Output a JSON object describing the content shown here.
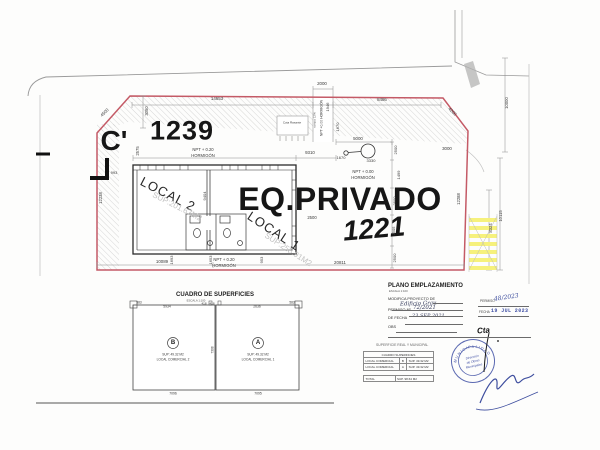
{
  "plan": {
    "parcel_top": "1239",
    "parcel_main": "1221",
    "area_label": "EQ.PRIVADO",
    "section_marker": "C'",
    "local2": "LOCAL 2",
    "local2_sup": "SUP:201.67M2",
    "local1": "LOCAL 1",
    "local1_sup": "SUP:258.91M2",
    "npt020": "NPT + 0.20",
    "npt000": "NPT + 0.00",
    "hormigon": "HORMIGÓN",
    "npt000_vertical": "NPT +0.00 HORMIGÓN",
    "rampa": "rampa 12%",
    "cota": "Cota Rasante",
    "dims": {
      "top_left": "14653",
      "entry_width": "2000",
      "top_right": "8486",
      "chamfer_left": "4500",
      "chamfer_right": "4200",
      "sidewalk_depth": "3050",
      "left_2575": "2575",
      "left_993": "993",
      "left_boundary": "12238",
      "building_front": "9310",
      "court_5000": "5000",
      "entry_1946": "1946",
      "entry_1670": "1670",
      "pole_offset": "1670",
      "pole_3330": "3330",
      "right_3000": "3000",
      "col_2500a": "2500",
      "col_1499": "1499",
      "col_2500b": "2500",
      "col_2505": "2505",
      "col_2500c": "2500",
      "court_2500": "2500",
      "local2_depth": "9404",
      "bottom_10089": "10089",
      "bottom_1693": "1693",
      "bottom_1653": "1653",
      "bottom_953": "953",
      "bottom_20811": "20811",
      "right_boundary": "12288",
      "cross_8324": "8324",
      "cross_10115": "10115",
      "street_10000": "10000"
    }
  },
  "surfaces": {
    "title": "CUADRO DE SUPERFICIES",
    "scale": "ESCALA 1:100",
    "unit_b": {
      "letter": "B",
      "sup": "SUP: 49.32 M2",
      "name": "LOCAL COMERCIAL 2"
    },
    "unit_a": {
      "letter": "A",
      "sup": "SUP: 49.32 M2",
      "name": "LOCAL COMERCIAL 1"
    },
    "dims": {
      "corner_left": "583",
      "b_top": "5934",
      "center_a": "418",
      "center_b": "418",
      "a_top": "2636",
      "corner_right": "583",
      "b_bottom": "7096",
      "a_bottom": "7095",
      "middle_height": "7308"
    }
  },
  "title_block": {
    "title": "PLANO EMPLAZAMIENTO",
    "scale": "ESCALA 1:100",
    "modifica_label": "MODIFICA PROYECTO DE",
    "modifica_value": "Edificio Grau",
    "permiso_label": "PERMISO Nº",
    "permiso_value": "72/2021",
    "de_fecha_label": "DE FECHA",
    "de_fecha_value": "23 SEP 2021",
    "obs_label": "OBS",
    "permiso2_label": "PERMISO",
    "permiso2_value": "48/2023",
    "fecha2_label": "FECHA",
    "fecha2_value": "19 JUL 2023"
  },
  "approval": {
    "header": "SUPERFICIE REAL Y MUNICIPAL",
    "table_title": "CUADRO SUPERFICIES",
    "row1_name": "LOCAL COMERCIAL",
    "row1_letter": "B",
    "row1_value": "SUP. 49.32 M2",
    "row2_name": "LOCAL COMERCIAL",
    "row2_letter": "A",
    "row2_value": "SUP. 49.32 M2",
    "total_label": "TOTAL",
    "total_value": "SUP. 98.64 M2",
    "stamp_arc": "MUNICIPALIDAD",
    "stamp_line1": "Dirección",
    "stamp_line2": "de Obras",
    "stamp_line3": "Municipales",
    "note": "Cta"
  },
  "colors": {
    "boundary": "#c45a66",
    "crosswalk_yellow": "#f6f17c",
    "stamp_blue": "#4050a5",
    "hatch_gray": "#c6c6c6"
  }
}
